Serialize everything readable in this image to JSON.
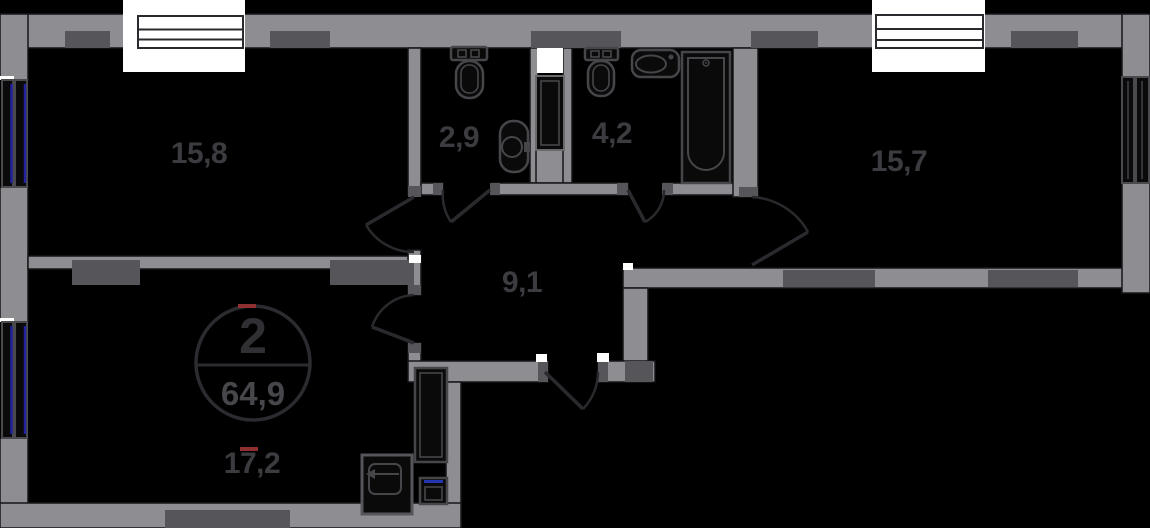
{
  "plan": {
    "title": "apartment floor plan",
    "apartment_badge": {
      "number": "2",
      "total_area": "64,9"
    },
    "rooms": [
      {
        "id": "living-room-1",
        "area": "15,8"
      },
      {
        "id": "bathroom-small",
        "area": "2,9"
      },
      {
        "id": "bathroom-large",
        "area": "4,2"
      },
      {
        "id": "living-room-2",
        "area": "15,7"
      },
      {
        "id": "hallway",
        "area": "9,1"
      },
      {
        "id": "kitchen-living-room",
        "area": "17,2"
      }
    ],
    "colors": {
      "background": "#000000",
      "wall": "#8e8e92",
      "wall_dark": "#55555a",
      "window_white": "#ffffff",
      "window_glass_blue": "#2323a0",
      "label_text": "#3b3b40",
      "fixture_outline": "#46464a",
      "accent_red_tick": "#8f2f2f",
      "appliance_blue": "#2336b0"
    }
  }
}
